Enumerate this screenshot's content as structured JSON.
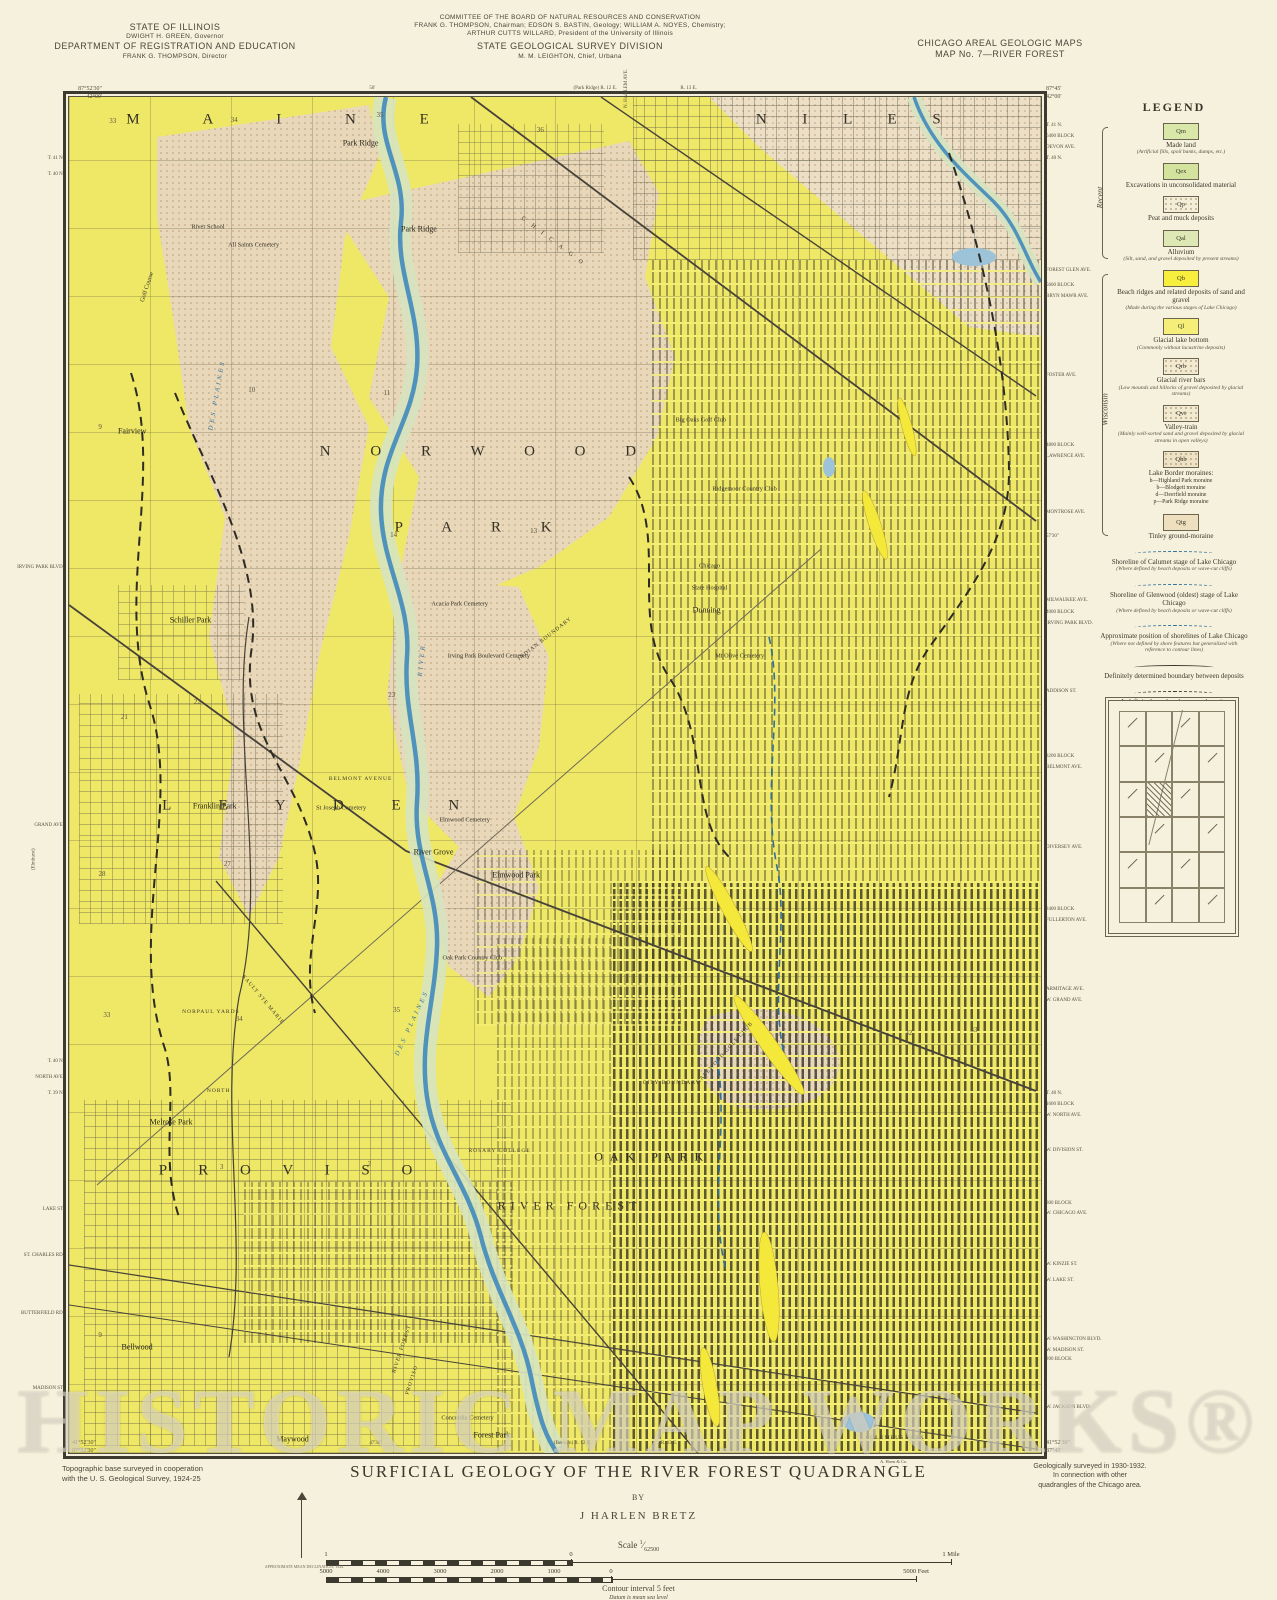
{
  "header": {
    "left": {
      "l1": "STATE OF ILLINOIS",
      "l2": "DWIGHT H. GREEN, Governor",
      "l3": "DEPARTMENT OF REGISTRATION AND EDUCATION",
      "l4": "FRANK G. THOMPSON, Director"
    },
    "center": {
      "l1": "COMMITTEE OF THE BOARD OF NATURAL RESOURCES AND CONSERVATION",
      "l2": "FRANK G. THOMPSON, Chairman; EDSON S. BASTIN, Geology; WILLIAM A. NOYES, Chemistry;",
      "l3": "ARTHUR CUTTS WILLARD, President of the University of Illinois",
      "l4": "STATE GEOLOGICAL SURVEY DIVISION",
      "l5": "M. M. LEIGHTON, Chief, Urbana"
    },
    "right": {
      "l1": "CHICAGO AREAL GEOLOGIC MAPS",
      "l2": "MAP No. 7—RIVER FOREST"
    }
  },
  "map": {
    "corners": {
      "tl1": "87°52'30\"",
      "tl2": "42°00'",
      "tr1": "87°45'",
      "tr2": "42°00'",
      "bl1": "41°52'30\"",
      "bl2": "87°52'30\"",
      "br1": "41°52'30\"",
      "br2": "87°45'"
    },
    "edge_top": [
      {
        "t": "50'",
        "x": 31
      },
      {
        "t": "(Park Ridge) R. 12 E.",
        "x": 52
      },
      {
        "t": "R. 13 E.",
        "x": 63
      },
      {
        "t": "N. HARLEM AVE.",
        "x": 55.5,
        "rot": -90
      }
    ],
    "edge_bottom": [
      {
        "t": "47'30\"",
        "x": 31
      },
      {
        "t": "(Berwyn) R. 12 E.",
        "x": 50
      },
      {
        "t": "R. 13 E.",
        "x": 61
      }
    ],
    "margin_left": [
      {
        "t": "T. 41 N.",
        "y": 4.4
      },
      {
        "t": "T. 40 N.",
        "y": 5.6
      },
      {
        "t": "IRVING PARK BLVD.",
        "y": 34.6
      },
      {
        "t": "GRAND AVE.",
        "y": 53.6
      },
      {
        "t": "(Elmhurst)",
        "y": 57.5,
        "rot": -90
      },
      {
        "t": "T. 40 N.",
        "y": 71.0
      },
      {
        "t": "NORTH AVE.",
        "y": 72.2
      },
      {
        "t": "T. 39 N.",
        "y": 73.4
      },
      {
        "t": "LAKE ST.",
        "y": 81.9
      },
      {
        "t": "ST. CHARLES RD.",
        "y": 85.3
      },
      {
        "t": "BUTTERFIELD RD.",
        "y": 89.6
      },
      {
        "t": "MADISON ST.",
        "y": 95.1
      }
    ],
    "margin_right": [
      {
        "t": "T. 41 N.",
        "y": 2.0
      },
      {
        "t": "6400 BLOCK",
        "y": 2.8
      },
      {
        "t": "DEVON AVE.",
        "y": 3.6
      },
      {
        "t": "T. 40 N.",
        "y": 4.4
      },
      {
        "t": "FOREST GLEN AVE.",
        "y": 12.7
      },
      {
        "t": "5600 BLOCK",
        "y": 13.8
      },
      {
        "t": "BRYN MAWR AVE.",
        "y": 14.6
      },
      {
        "t": "FOSTER AVE.",
        "y": 20.4
      },
      {
        "t": "4800 BLOCK",
        "y": 25.6
      },
      {
        "t": "LAWRENCE AVE.",
        "y": 26.4
      },
      {
        "t": "MONTROSE AVE.",
        "y": 30.5
      },
      {
        "t": "57'30\"",
        "y": 32.3
      },
      {
        "t": "MILWAUKEE AVE.",
        "y": 37.0
      },
      {
        "t": "4000 BLOCK",
        "y": 37.9
      },
      {
        "t": "IRVING PARK BLVD.",
        "y": 38.7
      },
      {
        "t": "ADDISON ST.",
        "y": 43.7
      },
      {
        "t": "3200 BLOCK",
        "y": 48.5
      },
      {
        "t": "BELMONT AVE.",
        "y": 49.3
      },
      {
        "t": "DIVERSEY AVE.",
        "y": 55.2
      },
      {
        "t": "2400 BLOCK",
        "y": 59.8
      },
      {
        "t": "FULLERTON AVE.",
        "y": 60.6
      },
      {
        "t": "ARMITAGE AVE.",
        "y": 65.7
      },
      {
        "t": "W. GRAND AVE.",
        "y": 66.5
      },
      {
        "t": "T. 40 N.",
        "y": 73.4
      },
      {
        "t": "1600 BLOCK",
        "y": 74.2
      },
      {
        "t": "W. NORTH AVE.",
        "y": 75.0
      },
      {
        "t": "W. DIVISION ST.",
        "y": 77.6
      },
      {
        "t": "800 BLOCK",
        "y": 81.5
      },
      {
        "t": "W. CHICAGO AVE.",
        "y": 82.2
      },
      {
        "t": "W. KINZIE ST.",
        "y": 86.0
      },
      {
        "t": "W. LAKE ST.",
        "y": 87.2
      },
      {
        "t": "W. WASHINGTON BLVD.",
        "y": 91.5
      },
      {
        "t": "W. MADISON ST.",
        "y": 92.3
      },
      {
        "t": "200 BLOCK",
        "y": 93.0
      },
      {
        "t": "W. JACKSON BLVD.",
        "y": 96.5
      }
    ],
    "labels": [
      {
        "t": "M A I N E",
        "x": 23,
        "y": 1.7,
        "c": "region",
        "ls": 30
      },
      {
        "t": "N I L E S",
        "x": 81,
        "y": 1.7,
        "c": "region",
        "ls": 16
      },
      {
        "t": "N O R W O O D",
        "x": 43,
        "y": 26.2,
        "c": "region",
        "ls": 18
      },
      {
        "t": "P A R K",
        "x": 42.5,
        "y": 31.8,
        "c": "region",
        "ls": 18
      },
      {
        "t": "L E Y D E N",
        "x": 26,
        "y": 52.3,
        "c": "region",
        "ls": 22
      },
      {
        "t": "P R O V I S O",
        "x": 23,
        "y": 79.2,
        "c": "region",
        "ls": 14
      },
      {
        "t": "RIVER FOREST",
        "x": 51.5,
        "y": 81.8,
        "c": "region2",
        "ls": 5
      },
      {
        "t": "OAK PARK",
        "x": 60,
        "y": 78.2,
        "c": "region2",
        "ls": 7
      },
      {
        "t": "Park Ridge",
        "x": 30,
        "y": 3.4,
        "c": "town"
      },
      {
        "t": "Park Ridge",
        "x": 36,
        "y": 9.7,
        "c": "town"
      },
      {
        "t": "Fairview",
        "x": 6.5,
        "y": 24.6,
        "c": "town"
      },
      {
        "t": "Schiller Park",
        "x": 12.5,
        "y": 38.6,
        "c": "town"
      },
      {
        "t": "Franklin Park",
        "x": 15,
        "y": 52.3,
        "c": "town"
      },
      {
        "t": "River Grove",
        "x": 37.5,
        "y": 55.7,
        "c": "town"
      },
      {
        "t": "Elmwood Park",
        "x": 46,
        "y": 57.4,
        "c": "town"
      },
      {
        "t": "Melrose Park",
        "x": 10.5,
        "y": 75.6,
        "c": "town"
      },
      {
        "t": "Bellwood",
        "x": 7,
        "y": 92.2,
        "c": "town"
      },
      {
        "t": "Maywood",
        "x": 23,
        "y": 99.0,
        "c": "town"
      },
      {
        "t": "Forest Park",
        "x": 43.5,
        "y": 98.7,
        "c": "town"
      },
      {
        "t": "Dunning",
        "x": 65.6,
        "y": 37.8,
        "c": "town"
      },
      {
        "t": "River School",
        "x": 14.3,
        "y": 9.6,
        "c": "feat"
      },
      {
        "t": "All Saints Cemetery",
        "x": 19,
        "y": 10.9,
        "c": "feat"
      },
      {
        "t": "Golf Course",
        "x": 8,
        "y": 14,
        "c": "feat",
        "r": -72
      },
      {
        "t": "Big Oaks Golf Club",
        "x": 65,
        "y": 23.8,
        "c": "feat"
      },
      {
        "t": "Ridgemoor Country Club",
        "x": 69.5,
        "y": 28.9,
        "c": "feat"
      },
      {
        "t": "Chicago",
        "x": 65.9,
        "y": 34.6,
        "c": "feat"
      },
      {
        "t": "State Hospital",
        "x": 65.9,
        "y": 36.2,
        "c": "feat"
      },
      {
        "t": "Mt Olive Cemetery",
        "x": 69,
        "y": 41.2,
        "c": "feat"
      },
      {
        "t": "Acacia Park Cemetery",
        "x": 40.2,
        "y": 37.4,
        "c": "feat"
      },
      {
        "t": "Irving Park Boulevard Cemetery",
        "x": 43.2,
        "y": 41.2,
        "c": "feat"
      },
      {
        "t": "St Joseph Cemetery",
        "x": 28,
        "y": 52.4,
        "c": "feat"
      },
      {
        "t": "Elmwood Cemetery",
        "x": 40.7,
        "y": 53.3,
        "c": "feat"
      },
      {
        "t": "Oak Park Country Club",
        "x": 41.5,
        "y": 63.5,
        "c": "feat"
      },
      {
        "t": "Concordia Cemetery",
        "x": 41,
        "y": 97.4,
        "c": "feat"
      },
      {
        "t": "COLUMBUS PARK",
        "x": 85,
        "y": 98.9,
        "c": "featc"
      },
      {
        "t": "ROSARY COLLEGE",
        "x": 44.3,
        "y": 77.7,
        "c": "featc"
      },
      {
        "t": "NORPAUL YARDS",
        "x": 14.6,
        "y": 67.5,
        "c": "featc"
      },
      {
        "t": "CITY BOUNDARY",
        "x": 62,
        "y": 72.7,
        "c": "featc"
      },
      {
        "t": "GALEWOOD GOLF CLUB",
        "x": 67.5,
        "y": 70.5,
        "c": "featc",
        "r": -48
      },
      {
        "t": "INDIAN BOUNDARY",
        "x": 49,
        "y": 40,
        "c": "featc",
        "r": -38
      },
      {
        "t": "SAULT STE MARIE",
        "x": 20,
        "y": 66.6,
        "c": "featc",
        "r": 50
      },
      {
        "t": "NORTH",
        "x": 15.4,
        "y": 73.3,
        "c": "featc"
      },
      {
        "t": "BELMONT AVENUE",
        "x": 30,
        "y": 50.3,
        "c": "featc"
      },
      {
        "t": "CHICAGO",
        "x": 50,
        "y": 10.8,
        "c": "rail",
        "r": 37
      },
      {
        "t": "DES PLAINES",
        "x": 15.2,
        "y": 22,
        "c": "riv",
        "r": -80
      },
      {
        "t": "RIVER",
        "x": 36.3,
        "y": 41.5,
        "c": "riv",
        "r": -84
      },
      {
        "t": "DES PLAINES",
        "x": 35.3,
        "y": 68.3,
        "c": "riv",
        "r": -65
      },
      {
        "t": "RIVER FOREST",
        "x": 34.3,
        "y": 92.3,
        "c": "featc",
        "r": -72
      },
      {
        "t": "PROVISO",
        "x": 35.3,
        "y": 94.6,
        "c": "featc",
        "r": -72
      },
      {
        "t": "33",
        "x": 4.5,
        "y": 1.8,
        "c": "sec"
      },
      {
        "t": "34",
        "x": 17,
        "y": 1.7,
        "c": "sec"
      },
      {
        "t": "35",
        "x": 32,
        "y": 1.3,
        "c": "sec"
      },
      {
        "t": "36",
        "x": 48.5,
        "y": 2.4,
        "c": "sec"
      },
      {
        "t": "9",
        "x": 3.2,
        "y": 24.3,
        "c": "sec"
      },
      {
        "t": "10",
        "x": 18.8,
        "y": 21.6,
        "c": "sec"
      },
      {
        "t": "11",
        "x": 32.7,
        "y": 21.8,
        "c": "sec"
      },
      {
        "t": "13",
        "x": 47.8,
        "y": 32,
        "c": "sec"
      },
      {
        "t": "14",
        "x": 33.4,
        "y": 32.3,
        "c": "sec"
      },
      {
        "t": "21",
        "x": 5.7,
        "y": 45.7,
        "c": "sec"
      },
      {
        "t": "22",
        "x": 13.2,
        "y": 44.6,
        "c": "sec"
      },
      {
        "t": "23",
        "x": 33.2,
        "y": 44.1,
        "c": "sec"
      },
      {
        "t": "27",
        "x": 16.3,
        "y": 56.6,
        "c": "sec"
      },
      {
        "t": "28",
        "x": 3.4,
        "y": 57.3,
        "c": "sec"
      },
      {
        "t": "33",
        "x": 3.9,
        "y": 67.7,
        "c": "sec"
      },
      {
        "t": "34",
        "x": 17.5,
        "y": 68,
        "c": "sec"
      },
      {
        "t": "35",
        "x": 33.7,
        "y": 67.3,
        "c": "sec"
      },
      {
        "t": "2",
        "x": 30.9,
        "y": 78.7,
        "c": "sec"
      },
      {
        "t": "3",
        "x": 15.7,
        "y": 78.9,
        "c": "sec"
      },
      {
        "t": "32",
        "x": 86.4,
        "y": 69,
        "c": "sec"
      },
      {
        "t": "33",
        "x": 93.1,
        "y": 68.8,
        "c": "sec"
      },
      {
        "t": "9",
        "x": 3.2,
        "y": 91.3,
        "c": "sec"
      },
      {
        "t": "16",
        "x": 90.8,
        "y": 95.9,
        "c": "sec"
      }
    ]
  },
  "legend": {
    "title": "LEGEND",
    "groups": [
      {
        "name": "Recent",
        "items": [
          {
            "code": "Qm",
            "label": "Made land",
            "note": "(Artificial fills, spoil banks, dumps, etc.)",
            "color": "#d9e7a9"
          },
          {
            "code": "Qex",
            "label": "Excavations in unconsolidated material",
            "color": "#d3e39e"
          },
          {
            "code": "Qp",
            "label": "Peat and muck deposits",
            "color": "#f4eed8",
            "stipple": true
          },
          {
            "code": "Qal",
            "label": "Alluvium",
            "note": "(Silt, sand, and gravel deposited by present streams)",
            "color": "#dde8b4"
          }
        ]
      },
      {
        "name": "Wisconsin",
        "items": [
          {
            "code": "Qb",
            "label": "Beach ridges and related deposits of sand and gravel",
            "note": "(Made during the various stages of Lake Chicago)",
            "color": "#f7ee3d"
          },
          {
            "code": "Ql",
            "label": "Glacial lake bottom",
            "note": "(Commonly without lacustrine deposits)",
            "color": "#f5ef7a"
          },
          {
            "code": "Qrb",
            "label": "Glacial river bars",
            "note": "(Low mounds and hillocks of gravel deposited by glacial streams)",
            "color": "#f1e9d0",
            "stipple": true
          },
          {
            "code": "Qvt",
            "label": "Valley-train",
            "note": "(Mainly well-sorted sand and gravel deposited by glacial streams in open valleys)",
            "color": "#f1e9d0",
            "stipple": true
          },
          {
            "code": "Qhb",
            "label": "Lake Border moraines:",
            "sub": [
              "h—Highland Park moraine",
              "b—Blodgett moraine",
              "d—Deerfield moraine",
              "p—Park Ridge moraine"
            ],
            "color": "#eee2c6",
            "stipple": true
          },
          {
            "code": "Qtg",
            "label": "Tinley ground-moraine",
            "color": "#eee0bf"
          }
        ]
      }
    ],
    "line_items": [
      {
        "label": "Shoreline of Calumet stage of Lake Chicago",
        "note": "(Where defined by beach deposits or wave-cut cliffs)",
        "style": "blue"
      },
      {
        "label": "Shoreline of Glenwood (oldest) stage of Lake Chicago",
        "note": "(Where defined by beach deposits or wave-cut cliffs)",
        "style": "blue"
      },
      {
        "label": "Approximate position of shorelines of Lake Chicago",
        "note": "(Where not defined by shore features but generalized with reference to contour lines)",
        "style": "blue"
      },
      {
        "label": "Definitely determined boundary between deposits",
        "style": "solid"
      },
      {
        "label": "Indefinite boundary between deposits",
        "style": "darkdash"
      },
      {
        "label": "Sand or gravel pit",
        "symbol": "✕"
      },
      {
        "label": "Clay pit",
        "symbol": "✕"
      }
    ]
  },
  "footer": {
    "title": "SURFICIAL GEOLOGY OF THE RIVER FOREST QUADRANGLE",
    "by": "BY",
    "author": "J HARLEN BRETZ",
    "left1": "Topographic base surveyed in cooperation",
    "left2": "with the U. S. Geological Survey, 1924-25",
    "right1": "Geologically surveyed in 1930-1932.",
    "right2": "In connection with other",
    "right3": "quadrangles of the Chicago area.",
    "printer": "A. Hoen & Co.",
    "scale_label": "Scale",
    "scale_num": "1",
    "scale_den": "62500",
    "contour": "Contour interval 5 feet",
    "datum": "Datum is mean sea level",
    "declination": "APPROXIMATE MEAN DECLINATION, 1924",
    "mile_bar": [
      {
        "t": "1",
        "x": 0
      },
      {
        "t": "0",
        "x": 245
      },
      {
        "t": "1 Mile",
        "x": 625
      }
    ],
    "feet_bar": [
      {
        "t": "5000",
        "x": 0
      },
      {
        "t": "4000",
        "x": 57
      },
      {
        "t": "3000",
        "x": 114
      },
      {
        "t": "2000",
        "x": 171
      },
      {
        "t": "1000",
        "x": 228
      },
      {
        "t": "0",
        "x": 285
      },
      {
        "t": "5000 Feet",
        "x": 590
      }
    ]
  },
  "watermark": "HISTORIC MAP WORKS®"
}
